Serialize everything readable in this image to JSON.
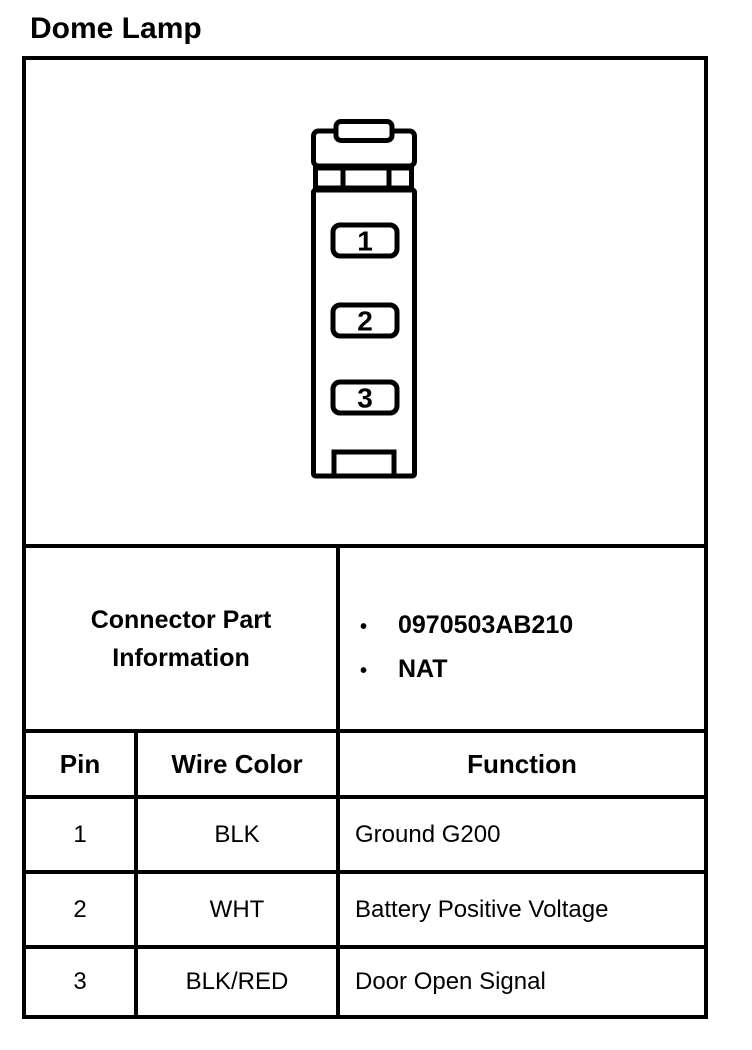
{
  "page": {
    "title": "Dome Lamp"
  },
  "colors": {
    "ink": "#000000",
    "paper": "#ffffff"
  },
  "connector_diagram": {
    "description": "3-cavity connector face view, vertical orientation",
    "pin_labels": [
      "1",
      "2",
      "3"
    ]
  },
  "part_info": {
    "label": "Connector Part Information",
    "bullet": "•",
    "items": [
      "0970503AB210",
      "NAT"
    ]
  },
  "pin_table": {
    "headers": [
      "Pin",
      "Wire Color",
      "Function"
    ],
    "rows": [
      {
        "pin": "1",
        "wire_color": "BLK",
        "function": "Ground G200"
      },
      {
        "pin": "2",
        "wire_color": "WHT",
        "function": "Battery Positive Voltage"
      },
      {
        "pin": "3",
        "wire_color": "BLK/RED",
        "function": "Door Open Signal"
      }
    ]
  }
}
